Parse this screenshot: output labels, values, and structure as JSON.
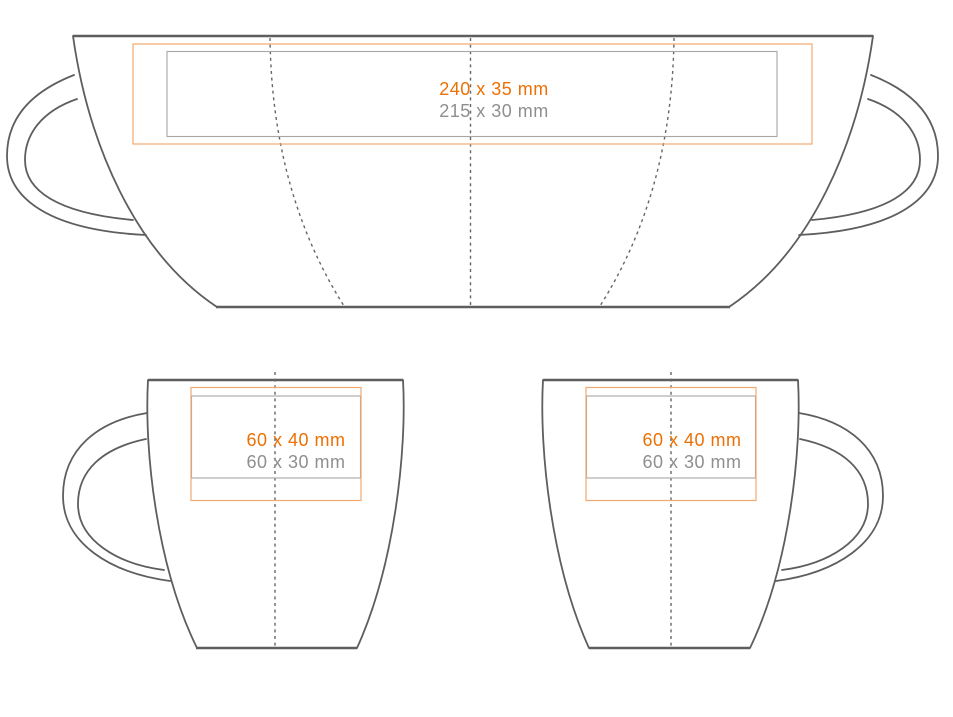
{
  "colors": {
    "background": "#FFFFFF",
    "outline": "#5E5E5E",
    "guide": "#666666",
    "print_area_accent": "#EC7004",
    "print_area_border": "#F3A96E",
    "safe_area_text": "#8F8F8F",
    "safe_area_border": "#A6A6A6"
  },
  "views": {
    "wrap": {
      "print_area": "240 x 35 mm",
      "safe_area": "215 x 30 mm"
    },
    "side_left_handle": {
      "print_area": "60 x 40 mm",
      "safe_area": "60 x 30 mm"
    },
    "side_right_handle": {
      "print_area": "60 x 40 mm",
      "safe_area": "60 x 30 mm"
    }
  }
}
